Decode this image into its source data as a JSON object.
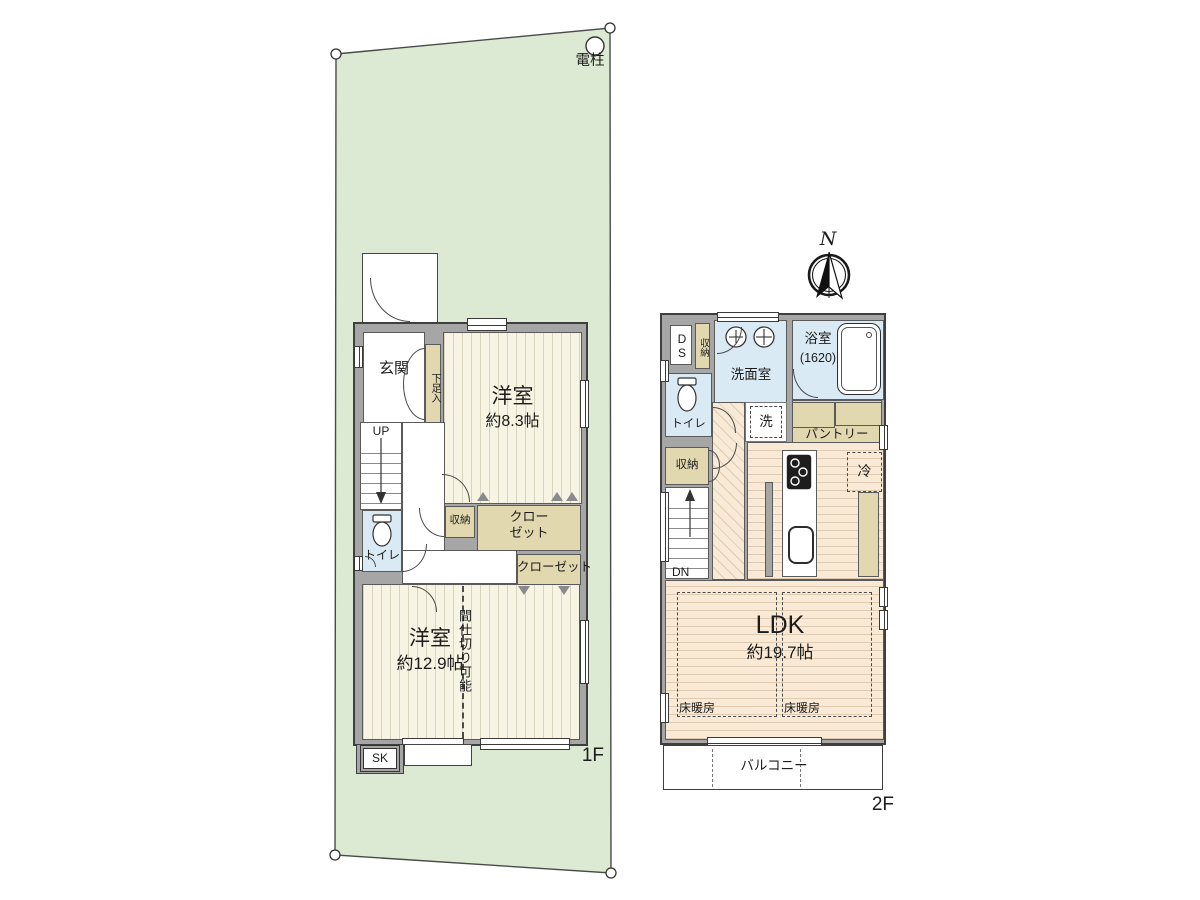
{
  "site": {
    "pole_label": "電柱"
  },
  "compass": {
    "north_label": "N"
  },
  "f1": {
    "floor_label": "1F",
    "genkan": "玄関",
    "shoe": "下足入",
    "room1_name": "洋室",
    "room1_size": "約8.3帖",
    "up": "UP",
    "toilet": "トイレ",
    "storage": "収納",
    "closet1": "クロー\nゼット",
    "closet2": "クローゼット",
    "room2_name": "洋室",
    "room2_size": "約12.9帖",
    "partition": "間仕切り可能",
    "sk": "SK"
  },
  "f2": {
    "floor_label": "2F",
    "ds": "DS",
    "storage_top": "収納",
    "washroom": "洗面室",
    "bath_name": "浴室",
    "bath_size": "(1620)",
    "toilet": "トイレ",
    "washer": "洗",
    "pantry": "パントリー",
    "storage_mid": "収納",
    "dn": "DN",
    "fridge": "冷",
    "ldk_name": "LDK",
    "ldk_size": "約19.7帖",
    "heaters": [
      "床暖房",
      "床暖房"
    ],
    "balcony": "バルコニー"
  },
  "colors": {
    "site_green": "#dcead3",
    "wall_gray": "#a6a6a6",
    "floor_cream": "#f7f4e3",
    "floor_wood": "#f8ead7",
    "wet_blue": "#daeaf4",
    "storage_tan": "#e2d8b0",
    "outline": "#3f3f3f"
  }
}
